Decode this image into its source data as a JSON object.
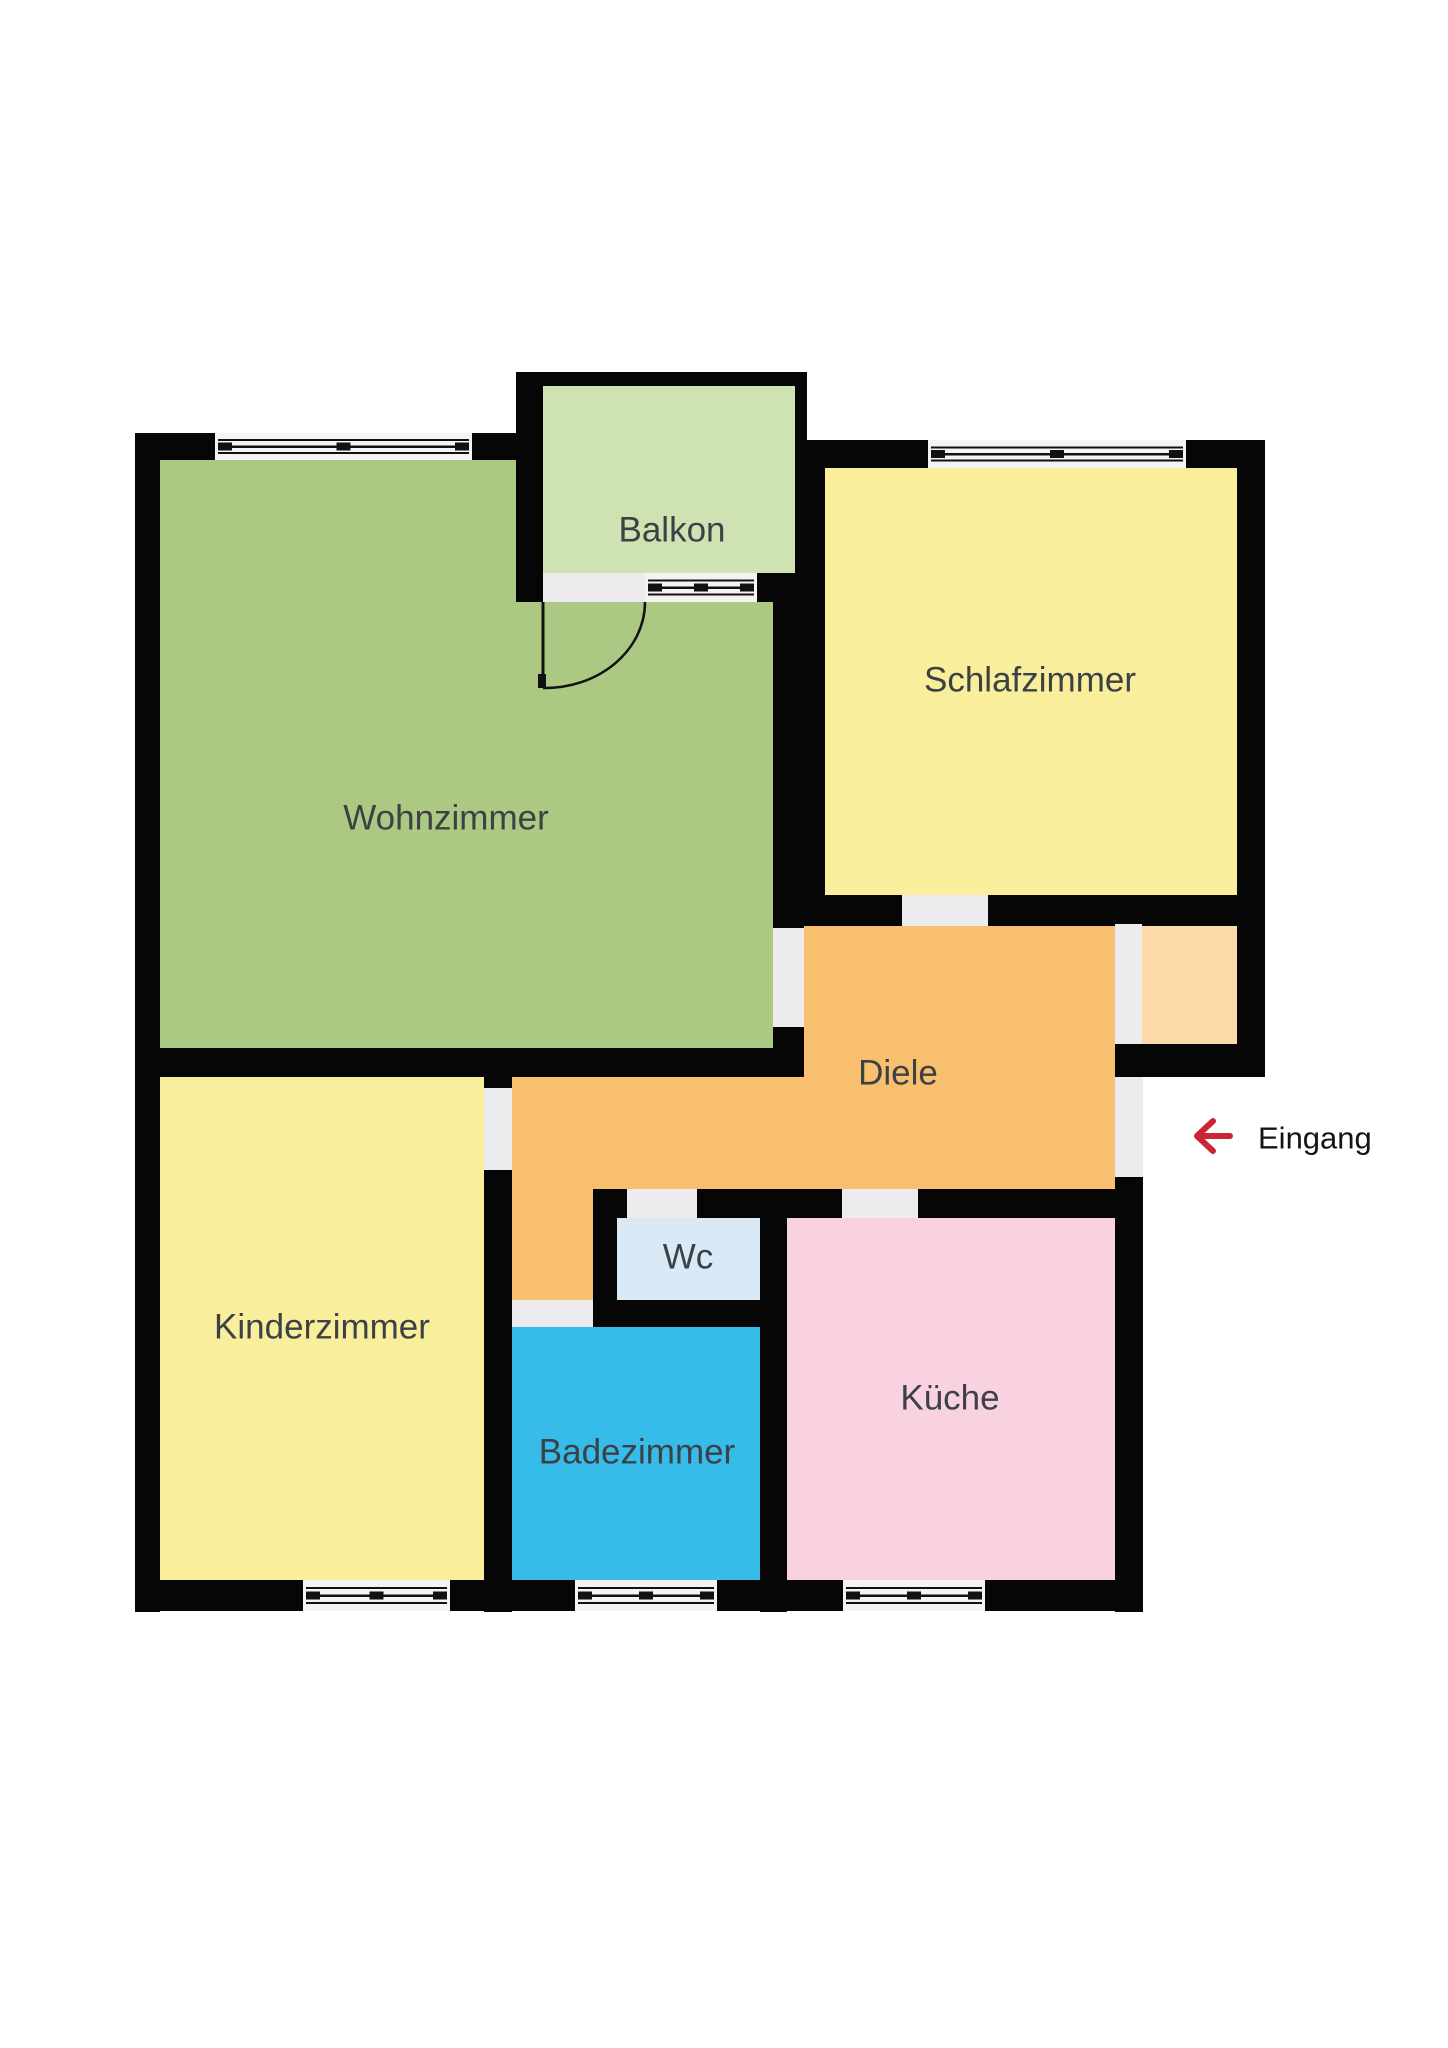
{
  "rooms": {
    "wohnzimmer": {
      "label": "Wohnzimmer",
      "color": "#abc983"
    },
    "balkon": {
      "label": "Balkon",
      "color": "#cee3b1"
    },
    "schlafzimmer": {
      "label": "Schlafzimmer",
      "color": "#f9ee9b"
    },
    "diele": {
      "label": "Diele",
      "color": "#f7bf6e"
    },
    "storage_nook": {
      "label": "",
      "color": "#fbd9a8"
    },
    "kinderzimmer": {
      "label": "Kinderzimmer",
      "color": "#f9ee9b"
    },
    "wc": {
      "label": "Wc",
      "color": "#d9eaf6"
    },
    "badezimmer": {
      "label": "Badezimmer",
      "color": "#37bce9"
    },
    "kueche": {
      "label": "Küche",
      "color": "#f8d2e0"
    }
  },
  "entrance": {
    "label": "Eingang",
    "arrow_color": "#cb2532",
    "text_color": "#141414"
  },
  "palette": {
    "background": "#ffffff",
    "wall": "#060606",
    "door_gap": "#ececee",
    "window_band": "#f4f4f5",
    "window_line": "#111111",
    "label_color": "#3c4145"
  }
}
